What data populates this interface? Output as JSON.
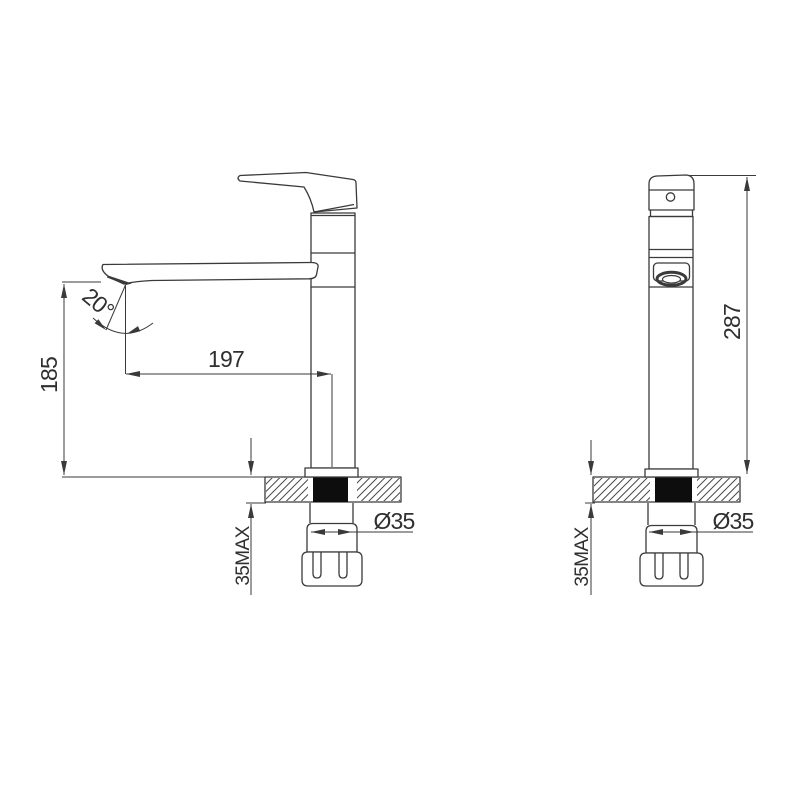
{
  "left_view": {
    "angle_label": "20°",
    "reach_label": "197",
    "height_label": "185",
    "deck_label": "35MAX",
    "shank_label": "Ø35"
  },
  "right_view": {
    "height_label": "287",
    "deck_label": "35MAX",
    "shank_label": "Ø35"
  },
  "colors": {
    "line": "#3a3a3a",
    "hole_fill": "#0d0d0d",
    "background": "#ffffff"
  }
}
